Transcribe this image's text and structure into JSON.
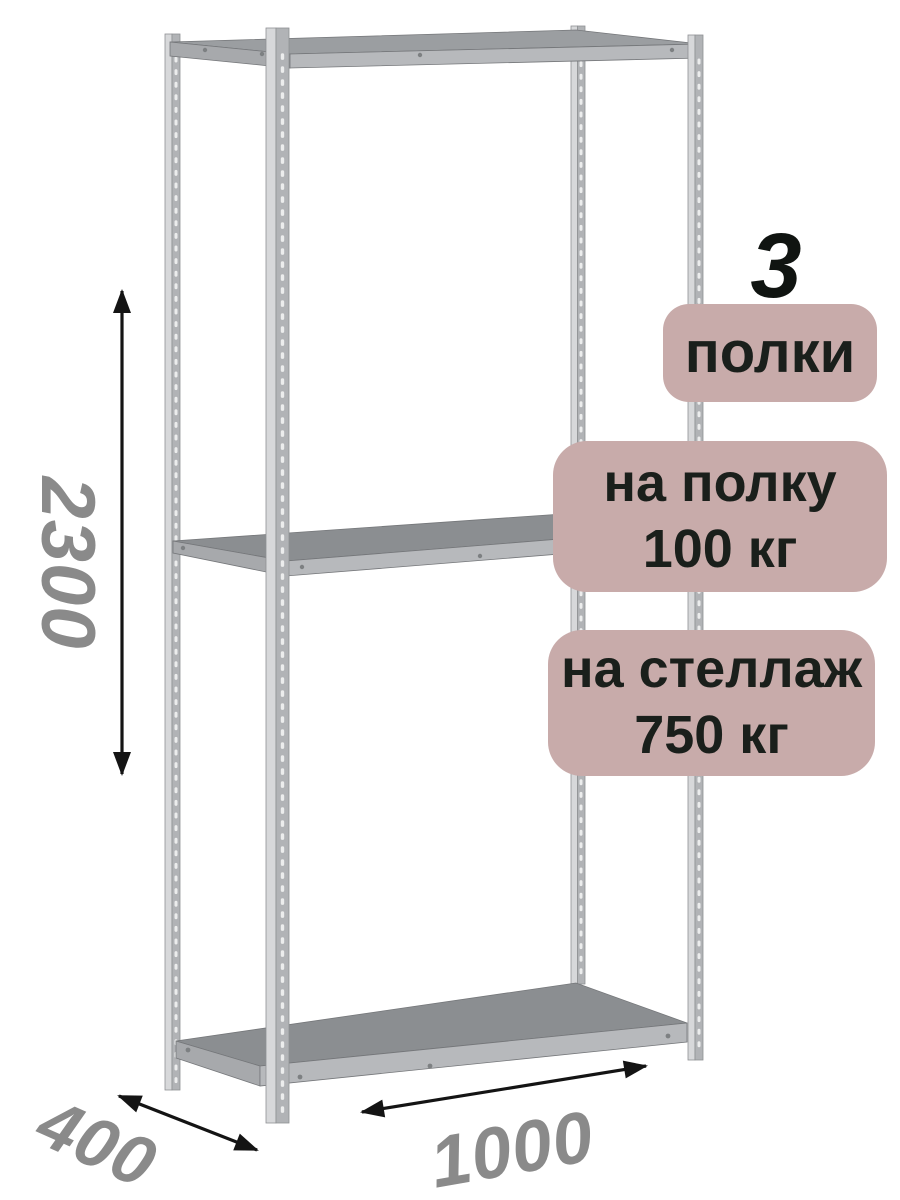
{
  "shelf_count": {
    "number": "3",
    "label": "полки"
  },
  "per_shelf_load": {
    "line1": "на полку",
    "line2": "100 кг"
  },
  "per_rack_load": {
    "line1": "на стеллаж",
    "line2": "750 кг"
  },
  "dimensions": {
    "height": "2300",
    "depth": "400",
    "width": "1000"
  },
  "colors": {
    "background": "#ffffff",
    "badge_fill": "#c8abaa",
    "badge_text": "#1a1f1b",
    "dimension_text": "#8a8a8a",
    "arrow": "#141414",
    "metal_light": "#d7d8da",
    "metal_mid": "#b1b3b6",
    "metal_edge": "#8f9194",
    "shelf_surface": "#8b8e91",
    "shelf_front": "#b7b9bc",
    "shelf_side": "#a7a9ac"
  }
}
